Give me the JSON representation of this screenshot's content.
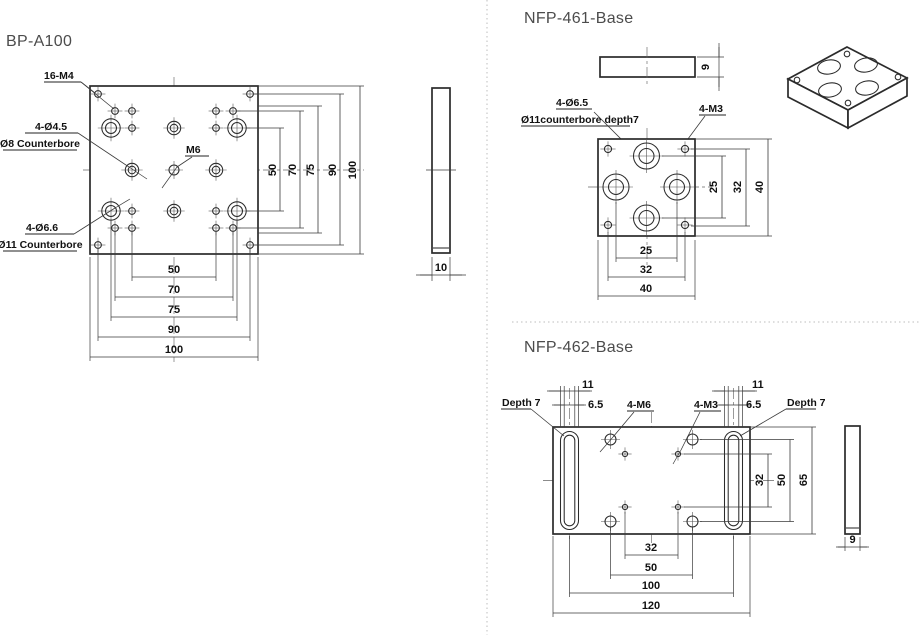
{
  "colors": {
    "line": "#2b2b2b",
    "title_text": "#4c4c4c",
    "divider": "#c9c9c9"
  },
  "titles": {
    "bp": "BP-A100",
    "n461": "NFP-461-Base",
    "n462": "NFP-462-Base"
  },
  "bp": {
    "labels": {
      "m4": "16-M4",
      "d45": "4-Ø4.5",
      "cb8": "Ø8 Counterbore",
      "m6": "M6",
      "d66": "4-Ø6.6",
      "cb11": "Ø11 Counterbore",
      "thickness": "10"
    },
    "dims_bottom": [
      "50",
      "70",
      "75",
      "90",
      "100"
    ],
    "dims_right": [
      "50",
      "70",
      "75",
      "90",
      "100"
    ]
  },
  "n461": {
    "labels": {
      "d65": "4-Ø6.5",
      "cb11": "Ø11counterbore depth7",
      "m3": "4-M3",
      "thickness": "9"
    },
    "dims_bottom": [
      "25",
      "32",
      "40"
    ],
    "dims_right": [
      "25",
      "32",
      "40"
    ]
  },
  "n462": {
    "labels": {
      "depth_left": "Depth 7",
      "depth_right": "Depth 7",
      "slot_cb_left": "11",
      "slot_cb_right": "11",
      "slot_left": "6.5",
      "slot_right": "6.5",
      "m6": "4-M6",
      "m3": "4-M3",
      "thickness": "9"
    },
    "dims_bottom": [
      "32",
      "50",
      "100",
      "120"
    ],
    "dims_right": [
      "32",
      "50",
      "65"
    ]
  }
}
